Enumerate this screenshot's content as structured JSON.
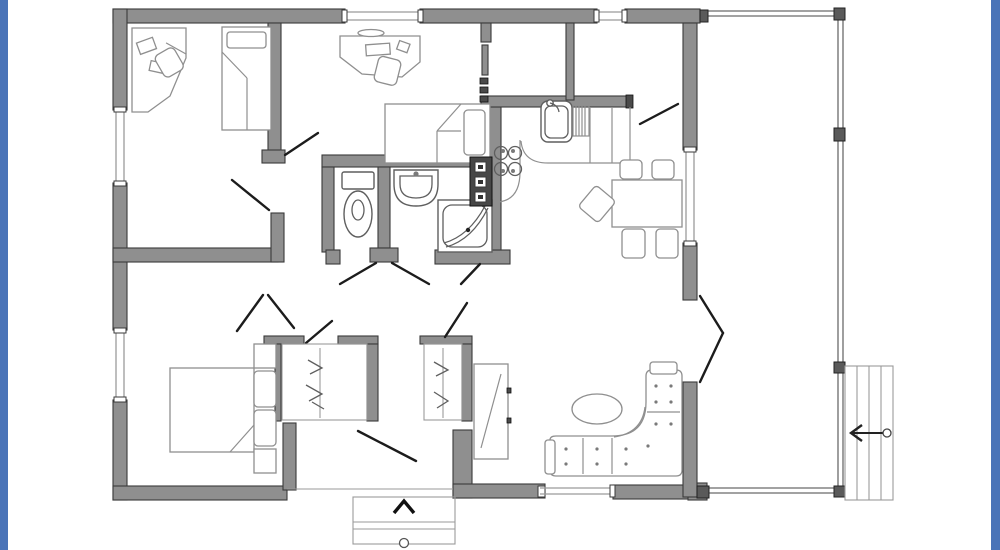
{
  "artwork": {
    "kind": "residential floor plan, top-down architectural drawing",
    "text_on_image": "none",
    "frame": {
      "left_bar": true,
      "right_bar": true
    }
  },
  "colors": {
    "page_bg": "#ffffff",
    "frame_blue": "#4a74b8",
    "wall_fill": "#8f8f8f",
    "wall_outline": "#3a3a3a",
    "furniture_line": "#8f8f8f",
    "fixture_line": "#5f5f5f",
    "door_line": "#1c1c1c",
    "window_line": "#9a9a9a",
    "deck_line": "#6b6b6b",
    "appliance_dark": "#474747"
  },
  "rooms": [
    {
      "name": "bedroom-top-left",
      "furniture": [
        "corner-desk",
        "desk-chair",
        "computer-items",
        "single-bed-with-pillow"
      ]
    },
    {
      "name": "bedroom-top-middle",
      "furniture": [
        "desk",
        "desk-chair",
        "keyboard",
        "single-bed-with-pillow"
      ]
    },
    {
      "name": "wc-room",
      "furniture": [
        "toilet"
      ]
    },
    {
      "name": "washroom",
      "furniture": [
        "washbasin"
      ]
    },
    {
      "name": "shower-room",
      "furniture": [
        "corner-shower-with-curved-glass-door"
      ]
    },
    {
      "name": "kitchen",
      "furniture": [
        "l-shaped-counter",
        "double-sink-with-faucet",
        "dish-rack",
        "cooktop-4-burners",
        "tall-appliance-column-3-units"
      ]
    },
    {
      "name": "dining-area",
      "furniture": [
        "rectangular-table",
        "chair",
        "chair",
        "chair",
        "chair",
        "angled-chair"
      ]
    },
    {
      "name": "living-area",
      "furniture": [
        "l-shaped-corner-sofa-tufted",
        "left-armrest",
        "head-cushion",
        "oval-coffee-table"
      ]
    },
    {
      "name": "master-bedroom",
      "furniture": [
        "double-bed",
        "nightstand",
        "nightstand",
        "pillow",
        "pillow"
      ]
    },
    {
      "name": "hallway",
      "furniture": [
        "closet-with-hanging-clothes",
        "closet-with-hanging-clothes",
        "tall-cabinet-with-diagonal"
      ]
    },
    {
      "name": "vestibule",
      "furniture": []
    },
    {
      "name": "storage-room",
      "furniture": []
    }
  ],
  "openings": {
    "window_count": 6,
    "door_swing_count": 12,
    "hinge_tick_marks": 3
  },
  "deck": {
    "railing_sides": [
      "top",
      "right",
      "bottom"
    ],
    "post_count": 6,
    "steps": {
      "tread_lines": 3,
      "direction_arrow": "left",
      "start_marker": "circle"
    }
  },
  "entry_porch": {
    "position": "bottom-center",
    "step_lines": 2,
    "direction_arrow": "up",
    "start_marker": "circle"
  }
}
